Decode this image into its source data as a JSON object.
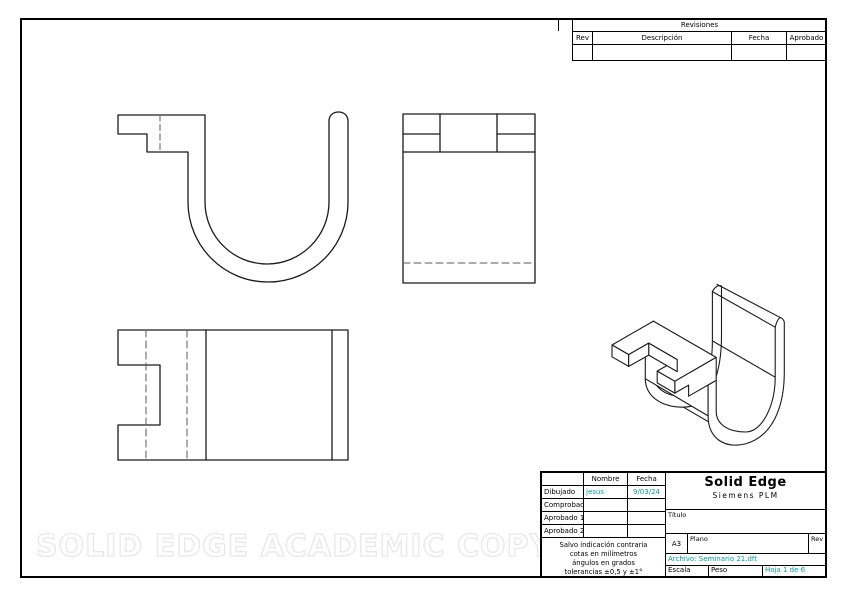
{
  "watermark": "SOLID EDGE ACADEMIC COPY",
  "colors": {
    "accent_teal": "#0A9A9A",
    "line_black": "#1A1A1A",
    "hidden_line_gray": "#5A5A5A",
    "watermark_gray": "#E8E8E8"
  },
  "revisions": {
    "title": "Revisiones",
    "columns": [
      "Rev",
      "Descripción",
      "Fecha",
      "Aprobado"
    ]
  },
  "title_block": {
    "signatures": {
      "name_header": "Nombre",
      "date_header": "Fecha",
      "rows": [
        {
          "label": "Dibujado",
          "name": "jesus",
          "date": "9/03/24"
        },
        {
          "label": "Comprobado",
          "name": "",
          "date": ""
        },
        {
          "label": "Aprobado 1",
          "name": "",
          "date": ""
        },
        {
          "label": "Aprobado 2",
          "name": "",
          "date": ""
        }
      ]
    },
    "note": [
      "Salvo indicación contraria",
      "cotas en milímetros",
      "ángulos en grados",
      "tolerancias ±0,5 y ±1°"
    ],
    "brand": {
      "name": "Solid Edge",
      "subtitle": "Siemens PLM"
    },
    "titulo_label": "Título",
    "sheet_format": "A3",
    "plano_label": "Plano",
    "rev_label": "Rev",
    "archivo": "Archivo: Seminario 21.dft",
    "escala_label": "Escala",
    "peso_label": "Peso",
    "hoja": "Hoja 1 de 6"
  }
}
